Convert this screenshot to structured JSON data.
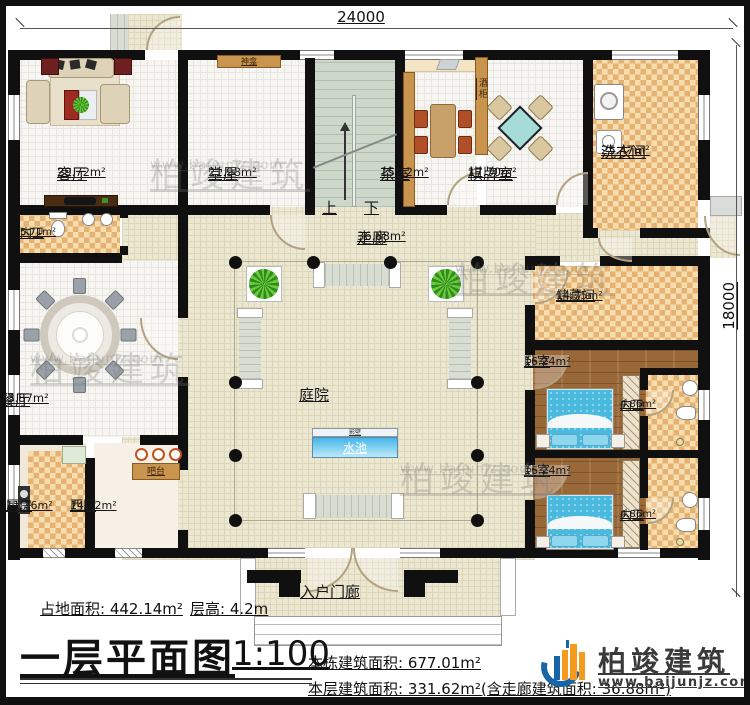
{
  "dimensions": {
    "width": "24000",
    "height": "18000"
  },
  "rooms": {
    "living": {
      "name": "客厅",
      "area": "29.72m²"
    },
    "hall": {
      "name": "堂屋",
      "area": "21.98m²"
    },
    "shrine": {
      "name": "神龛"
    },
    "tea": {
      "name": "茶室",
      "area": "15.12m²"
    },
    "wine_cabinet": {
      "name": "酒柜"
    },
    "chess": {
      "name": "棋牌室",
      "area": "17.70m²"
    },
    "laundry": {
      "name": "洗衣间",
      "area": "25.47m²"
    },
    "bath_left": {
      "name": "内卫",
      "area": "5.71m²"
    },
    "dining": {
      "name": "餐厅",
      "area": "33.87m²"
    },
    "kitchen": {
      "name": "厨房",
      "area": "11.76m²"
    },
    "west_kitchen": {
      "name": "西厨",
      "area": "14.32m²"
    },
    "bar": {
      "name": "吧台"
    },
    "corridor": {
      "name": "走廊",
      "area": "36.88m²"
    },
    "courtyard": {
      "name": "庭院"
    },
    "screen_wall": {
      "name": "影壁"
    },
    "pool": {
      "name": "水池"
    },
    "storage": {
      "name": "储藏间",
      "area": "14.75m²"
    },
    "bedroom1": {
      "name": "卧室",
      "area": "16.24m²"
    },
    "bath1": {
      "name": "内卫",
      "area": "4.86m²"
    },
    "bedroom2": {
      "name": "卧室",
      "area": "16.24m²"
    },
    "bath2": {
      "name": "内卫",
      "area": "4.86m²"
    },
    "entrance_porch": {
      "name": "入户门廊"
    }
  },
  "stairs": {
    "up": "上",
    "down": "下"
  },
  "footer": {
    "land_area": "占地面积: 442.14m²",
    "floor_height": "层高: 4.2m",
    "title": "一层平面图",
    "scale": "1:100",
    "building_total": "本栋建筑面积: 677.01m²",
    "floor_area": "本层建筑面积: 331.62m²(含走廊建筑面积: 36.88m²)"
  },
  "logo": {
    "company": "柏竣建筑",
    "website": "www.baijunjz.com"
  },
  "watermark": {
    "text": "柏竣建筑",
    "url": "www.baijunjz.com"
  },
  "colors": {
    "wall": "#101010",
    "courtyard_tile": "#ebe7d1",
    "checker": "#e4b272",
    "wood_floor": "#996839",
    "pool_blue": "#45b6e8",
    "logo_blue": "#1565a8",
    "logo_orange": "#f59a1f"
  }
}
